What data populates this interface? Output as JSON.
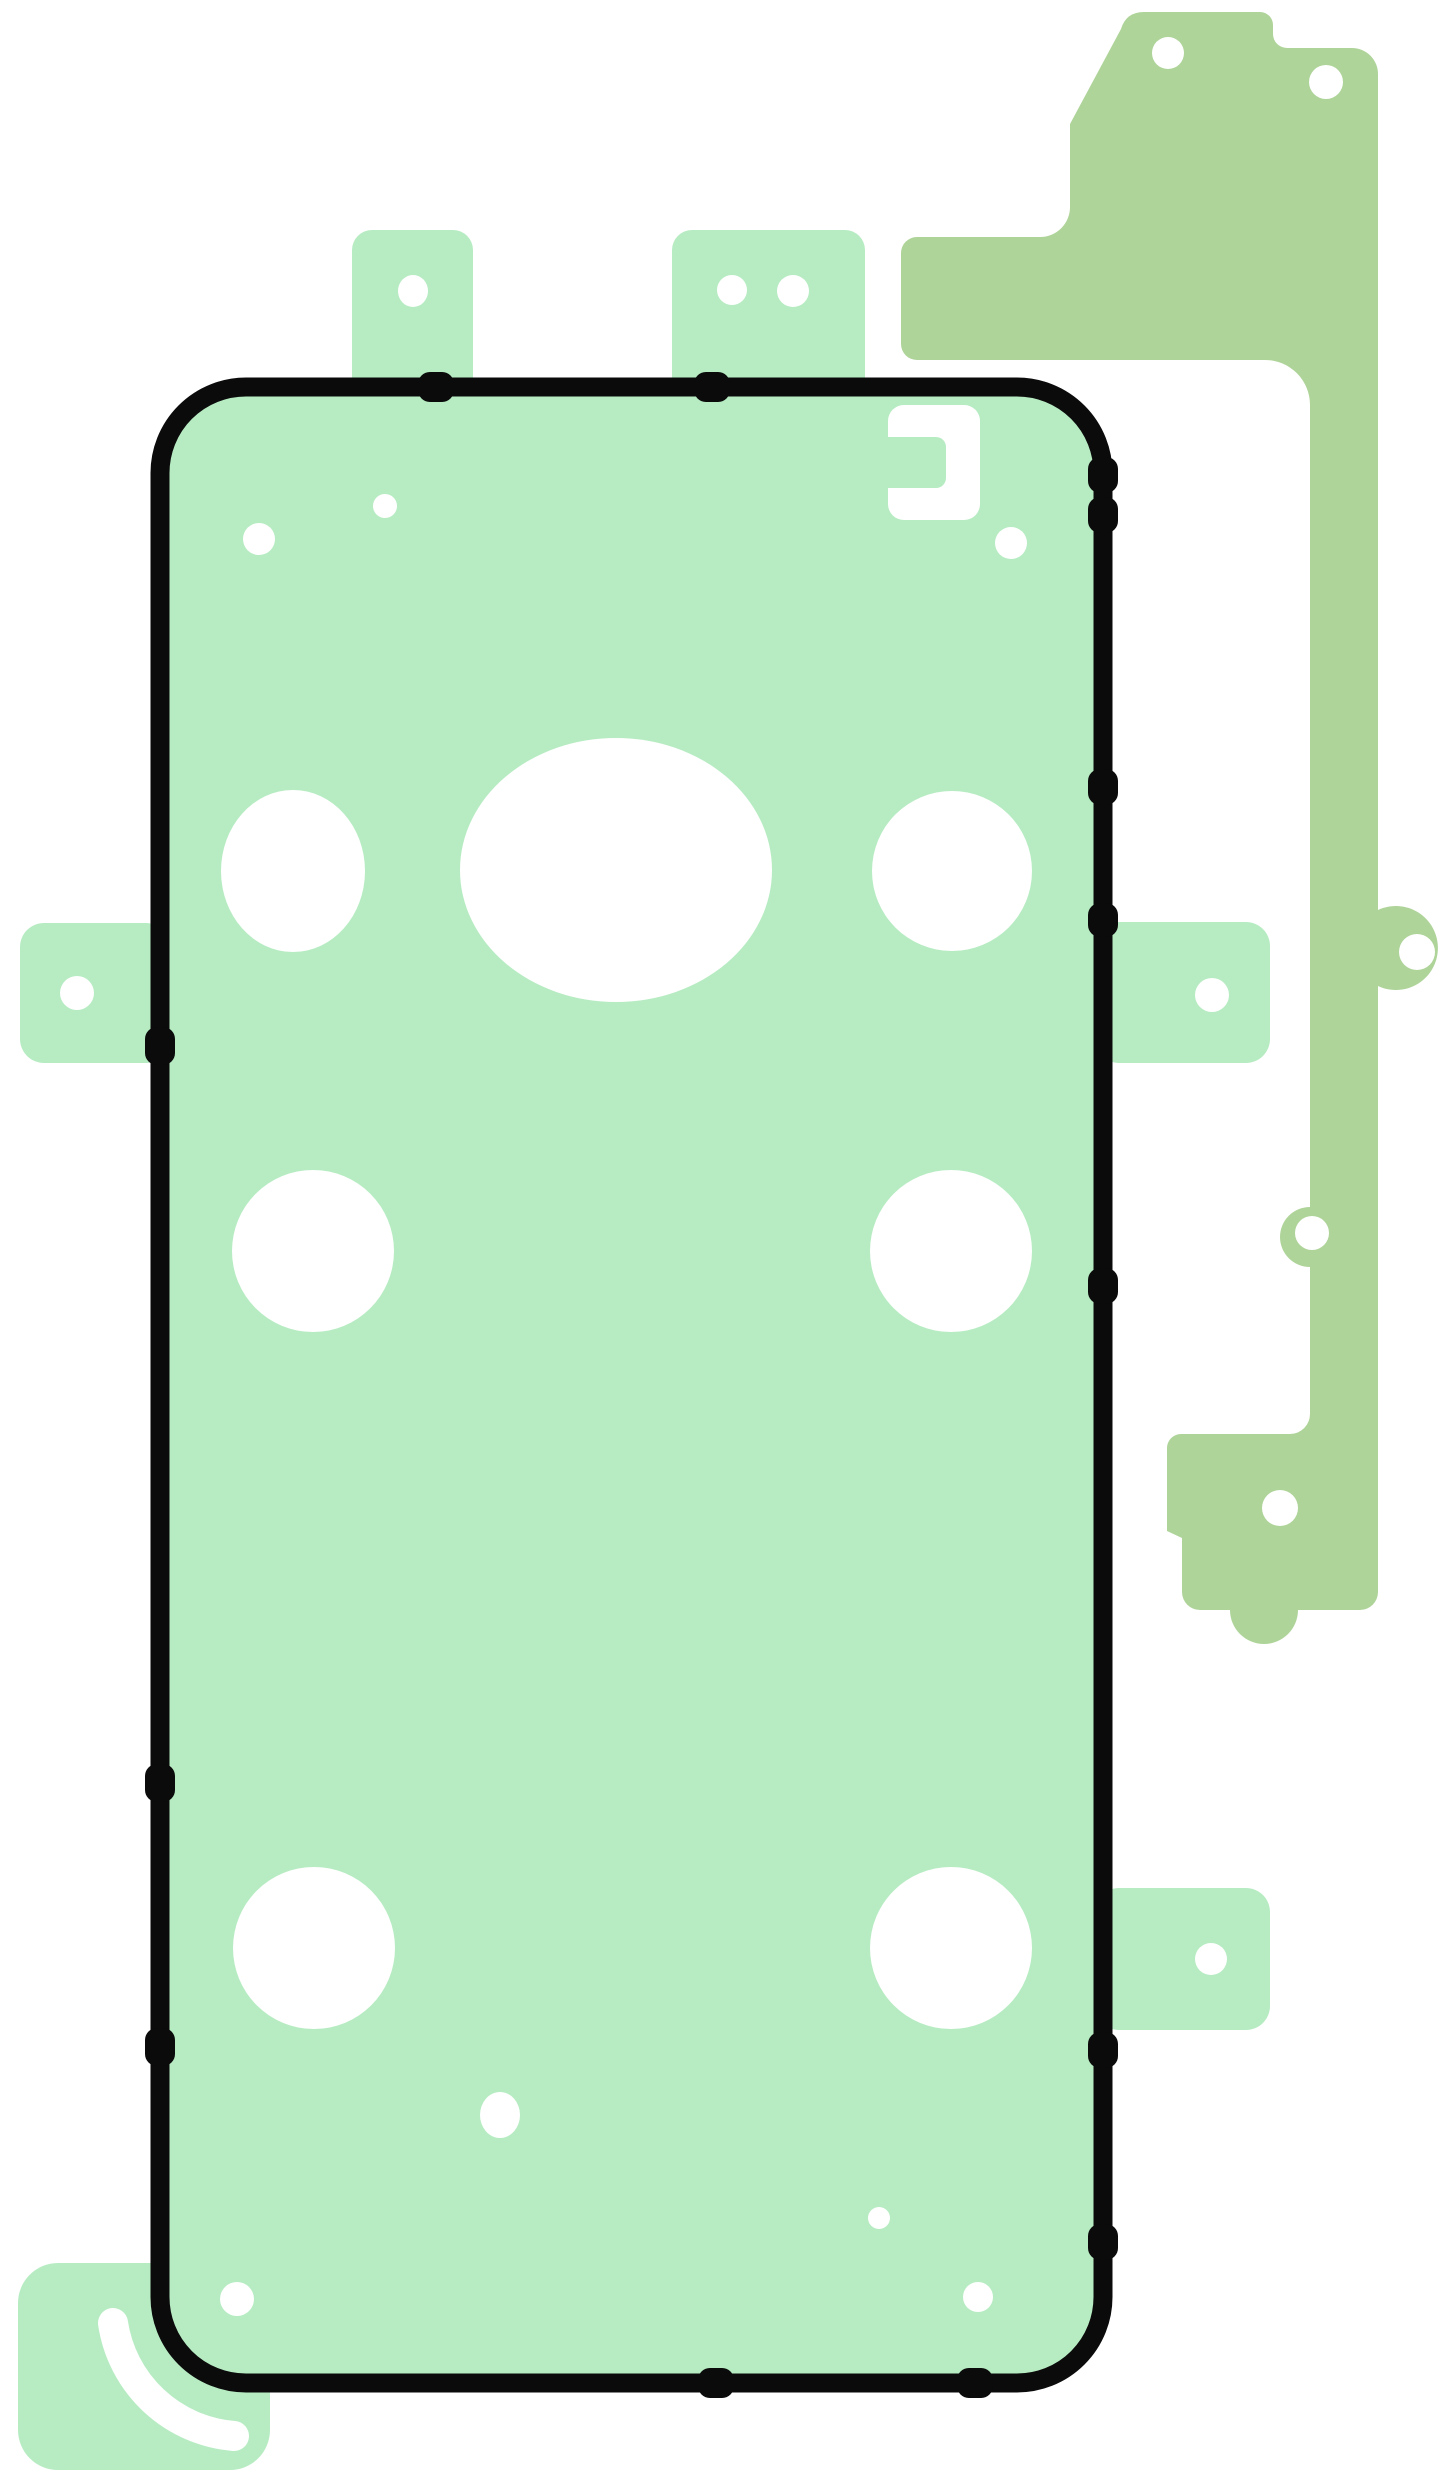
{
  "canvas": {
    "width": 1445,
    "height": 2473,
    "background": "#ffffff"
  },
  "colors": {
    "mint": "#b7ecc3",
    "olive": "#afd49a",
    "outline": "#0b0b0b",
    "white": "#ffffff"
  },
  "figure": {
    "name": "phone-back-adhesive-template",
    "description_parts": [
      "main-back-cover-adhesive-sheet",
      "side-rail-adhesive-strip",
      "pull-tabs",
      "camera-cutouts"
    ]
  },
  "layers": [
    {
      "kind": "path",
      "name": "side-rail-strip",
      "attrs": {
        "d": "M 1070 124 L 1121 29 Q 1126 12 1144 12 L 1260 12 A 13 13 0 0 1 1273 25 L 1273 34 A 14 14 0 0 0 1287 48 L 1352 48 A 26 26 0 0 1 1378 74 L 1378 910 A 42 42 0 1 1 1378 986 L 1378 1592 A 18 18 0 0 1 1360 1610 L 1298 1610 A 34 34 0 0 1 1230 1610 L 1200 1610 A 18 18 0 0 1 1182 1592 L 1182 1538 L 1167 1531 L 1167 1448 A 14 14 0 0 1 1181 1434 L 1290 1434 A 20 20 0 0 0 1310 1414 L 1310 1267 A 30 30 0 0 1 1310 1207 L 1310 405 A 45 45 0 0 0 1265 360 L 917 360 A 16 16 0 0 1 901 344 L 901 253 A 16 16 0 0 1 917 237 L 1040 237 A 30 30 0 0 0 1070 207 Z",
        "fill": "$olive"
      }
    },
    {
      "kind": "circle",
      "name": "strip-hole-top-left",
      "attrs": {
        "cx": 1168,
        "cy": 53,
        "r": 16,
        "fill": "$white"
      }
    },
    {
      "kind": "circle",
      "name": "strip-hole-top-right",
      "attrs": {
        "cx": 1326,
        "cy": 82,
        "r": 17,
        "fill": "$white"
      }
    },
    {
      "kind": "circle",
      "name": "strip-hole-side-bump",
      "attrs": {
        "cx": 1417,
        "cy": 952,
        "r": 18,
        "fill": "$white"
      }
    },
    {
      "kind": "circle",
      "name": "strip-hole-left-bump",
      "attrs": {
        "cx": 1312,
        "cy": 1233,
        "r": 17,
        "fill": "$white"
      }
    },
    {
      "kind": "circle",
      "name": "strip-hole-foot",
      "attrs": {
        "cx": 1280,
        "cy": 1508,
        "r": 18,
        "fill": "$white"
      }
    },
    {
      "kind": "rect",
      "name": "pull-tab-top-left",
      "attrs": {
        "x": 352,
        "y": 230,
        "width": 121,
        "height": 170,
        "rx": 20,
        "fill": "$mint"
      }
    },
    {
      "kind": "rect",
      "name": "pull-tab-top-right",
      "attrs": {
        "x": 672,
        "y": 230,
        "width": 193,
        "height": 170,
        "rx": 20,
        "fill": "$mint"
      }
    },
    {
      "kind": "rect",
      "name": "pull-tab-left-side",
      "attrs": {
        "x": 20,
        "y": 923,
        "width": 150,
        "height": 140,
        "rx": 24,
        "fill": "$mint"
      }
    },
    {
      "kind": "rect",
      "name": "pull-tab-right-upper",
      "attrs": {
        "x": 1095,
        "y": 922,
        "width": 175,
        "height": 141,
        "rx": 24,
        "fill": "$mint"
      }
    },
    {
      "kind": "rect",
      "name": "pull-tab-right-lower",
      "attrs": {
        "x": 1095,
        "y": 1888,
        "width": 175,
        "height": 142,
        "rx": 24,
        "fill": "$mint"
      }
    },
    {
      "kind": "rect",
      "name": "pull-tab-bottom-left",
      "attrs": {
        "x": 18,
        "y": 2263,
        "width": 252,
        "height": 207,
        "rx": 40,
        "fill": "$mint"
      }
    },
    {
      "kind": "rect",
      "name": "adhesive-sheet-body",
      "attrs": {
        "x": 154,
        "y": 381,
        "width": 955,
        "height": 2008,
        "rx": 92,
        "fill": "$mint"
      }
    },
    {
      "kind": "ellipse",
      "name": "tab-hole-top-left",
      "attrs": {
        "cx": 413,
        "cy": 291,
        "rx": 15,
        "ry": 16,
        "fill": "$white"
      }
    },
    {
      "kind": "circle",
      "name": "tab-hole-top-right-1",
      "attrs": {
        "cx": 732,
        "cy": 290,
        "r": 15,
        "fill": "$white"
      }
    },
    {
      "kind": "circle",
      "name": "tab-hole-top-right-2",
      "attrs": {
        "cx": 793,
        "cy": 291,
        "r": 16,
        "fill": "$white"
      }
    },
    {
      "kind": "circle",
      "name": "tab-hole-left-side",
      "attrs": {
        "cx": 77,
        "cy": 993,
        "r": 17,
        "fill": "$white"
      }
    },
    {
      "kind": "circle",
      "name": "tab-hole-right-upper",
      "attrs": {
        "cx": 1212,
        "cy": 995,
        "r": 17,
        "fill": "$white"
      }
    },
    {
      "kind": "circle",
      "name": "tab-hole-right-lower",
      "attrs": {
        "cx": 1211,
        "cy": 1959,
        "r": 16,
        "fill": "$white"
      }
    },
    {
      "kind": "rect",
      "name": "phone-outline",
      "attrs": {
        "x": 160,
        "y": 387,
        "width": 943,
        "height": 1996,
        "rx": 86,
        "fill": "none",
        "stroke": "$outline",
        "stroke-width": 19
      }
    },
    {
      "kind": "rect",
      "name": "edge-nub-left-1",
      "attrs": {
        "x": 145,
        "y": 1027,
        "width": 30,
        "height": 38,
        "rx": 12,
        "fill": "$outline"
      }
    },
    {
      "kind": "rect",
      "name": "edge-nub-left-2",
      "attrs": {
        "x": 145,
        "y": 1764,
        "width": 30,
        "height": 38,
        "rx": 12,
        "fill": "$outline"
      }
    },
    {
      "kind": "rect",
      "name": "edge-nub-left-3",
      "attrs": {
        "x": 145,
        "y": 2028,
        "width": 30,
        "height": 38,
        "rx": 12,
        "fill": "$outline"
      }
    },
    {
      "kind": "rect",
      "name": "edge-nub-right-1",
      "attrs": {
        "x": 1088,
        "y": 457,
        "width": 30,
        "height": 36,
        "rx": 12,
        "fill": "$outline"
      }
    },
    {
      "kind": "rect",
      "name": "edge-nub-right-2",
      "attrs": {
        "x": 1088,
        "y": 497,
        "width": 30,
        "height": 36,
        "rx": 12,
        "fill": "$outline"
      }
    },
    {
      "kind": "rect",
      "name": "edge-nub-right-3",
      "attrs": {
        "x": 1088,
        "y": 769,
        "width": 30,
        "height": 36,
        "rx": 12,
        "fill": "$outline"
      }
    },
    {
      "kind": "rect",
      "name": "edge-nub-right-4",
      "attrs": {
        "x": 1088,
        "y": 903,
        "width": 30,
        "height": 34,
        "rx": 12,
        "fill": "$outline"
      }
    },
    {
      "kind": "rect",
      "name": "edge-nub-right-5",
      "attrs": {
        "x": 1088,
        "y": 1268,
        "width": 30,
        "height": 36,
        "rx": 12,
        "fill": "$outline"
      }
    },
    {
      "kind": "rect",
      "name": "edge-nub-right-6",
      "attrs": {
        "x": 1088,
        "y": 2032,
        "width": 30,
        "height": 36,
        "rx": 12,
        "fill": "$outline"
      }
    },
    {
      "kind": "rect",
      "name": "edge-nub-right-7",
      "attrs": {
        "x": 1088,
        "y": 2224,
        "width": 30,
        "height": 36,
        "rx": 12,
        "fill": "$outline"
      }
    },
    {
      "kind": "rect",
      "name": "edge-nub-top-1",
      "attrs": {
        "x": 418,
        "y": 372,
        "width": 36,
        "height": 30,
        "rx": 12,
        "fill": "$outline"
      }
    },
    {
      "kind": "rect",
      "name": "edge-nub-top-2",
      "attrs": {
        "x": 694,
        "y": 372,
        "width": 36,
        "height": 30,
        "rx": 12,
        "fill": "$outline"
      }
    },
    {
      "kind": "rect",
      "name": "edge-nub-bottom-1",
      "attrs": {
        "x": 698,
        "y": 2368,
        "width": 36,
        "height": 30,
        "rx": 12,
        "fill": "$outline"
      }
    },
    {
      "kind": "rect",
      "name": "edge-nub-bottom-2",
      "attrs": {
        "x": 957,
        "y": 2368,
        "width": 36,
        "height": 30,
        "rx": 12,
        "fill": "$outline"
      }
    },
    {
      "kind": "rect",
      "name": "bracket-cutout",
      "attrs": {
        "x": 888,
        "y": 405,
        "width": 92,
        "height": 115,
        "rx": 16,
        "fill": "$white"
      }
    },
    {
      "kind": "rect",
      "name": "bracket-cutout-gap",
      "attrs": {
        "x": 860,
        "y": 437,
        "width": 86,
        "height": 51,
        "rx": 10,
        "fill": "$mint"
      }
    },
    {
      "kind": "circle",
      "name": "alignment-hole-top-1",
      "attrs": {
        "cx": 259,
        "cy": 539,
        "r": 16,
        "fill": "$white"
      }
    },
    {
      "kind": "circle",
      "name": "alignment-hole-top-2",
      "attrs": {
        "cx": 385,
        "cy": 506,
        "r": 12,
        "fill": "$white"
      }
    },
    {
      "kind": "circle",
      "name": "flash-hole",
      "attrs": {
        "cx": 1011,
        "cy": 543,
        "r": 16,
        "fill": "$white"
      }
    },
    {
      "kind": "ellipse",
      "name": "camera-hole-left",
      "attrs": {
        "cx": 293,
        "cy": 871,
        "rx": 72,
        "ry": 81,
        "fill": "$white"
      }
    },
    {
      "kind": "ellipse",
      "name": "camera-hole-center",
      "attrs": {
        "cx": 616,
        "cy": 870,
        "rx": 156,
        "ry": 132,
        "fill": "$white"
      }
    },
    {
      "kind": "circle",
      "name": "camera-hole-right",
      "attrs": {
        "cx": 952,
        "cy": 871,
        "r": 80,
        "fill": "$white"
      }
    },
    {
      "kind": "circle",
      "name": "cutout-mid-left",
      "attrs": {
        "cx": 313,
        "cy": 1251,
        "r": 81,
        "fill": "$white"
      }
    },
    {
      "kind": "circle",
      "name": "cutout-mid-right",
      "attrs": {
        "cx": 951,
        "cy": 1251,
        "r": 81,
        "fill": "$white"
      }
    },
    {
      "kind": "circle",
      "name": "cutout-lower-left",
      "attrs": {
        "cx": 314,
        "cy": 1948,
        "r": 81,
        "fill": "$white"
      }
    },
    {
      "kind": "circle",
      "name": "cutout-lower-right",
      "attrs": {
        "cx": 951,
        "cy": 1948,
        "r": 81,
        "fill": "$white"
      }
    },
    {
      "kind": "ellipse",
      "name": "small-oval-cutout",
      "attrs": {
        "cx": 500,
        "cy": 2115,
        "rx": 20,
        "ry": 23,
        "fill": "$white"
      }
    },
    {
      "kind": "circle",
      "name": "tiny-dot-cutout",
      "attrs": {
        "cx": 879,
        "cy": 2218,
        "r": 11,
        "fill": "$white"
      }
    },
    {
      "kind": "circle",
      "name": "bottom-hole-left",
      "attrs": {
        "cx": 237,
        "cy": 2299,
        "r": 17,
        "fill": "$white"
      }
    },
    {
      "kind": "circle",
      "name": "bottom-hole-right",
      "attrs": {
        "cx": 978,
        "cy": 2297,
        "r": 15,
        "fill": "$white"
      }
    },
    {
      "kind": "path",
      "name": "peel-arc-mark",
      "attrs": {
        "d": "M 113 2323 A 133 133 0 0 0 234 2436",
        "fill": "none",
        "stroke": "$white",
        "stroke-width": 30,
        "stroke-linecap": "round"
      }
    }
  ]
}
